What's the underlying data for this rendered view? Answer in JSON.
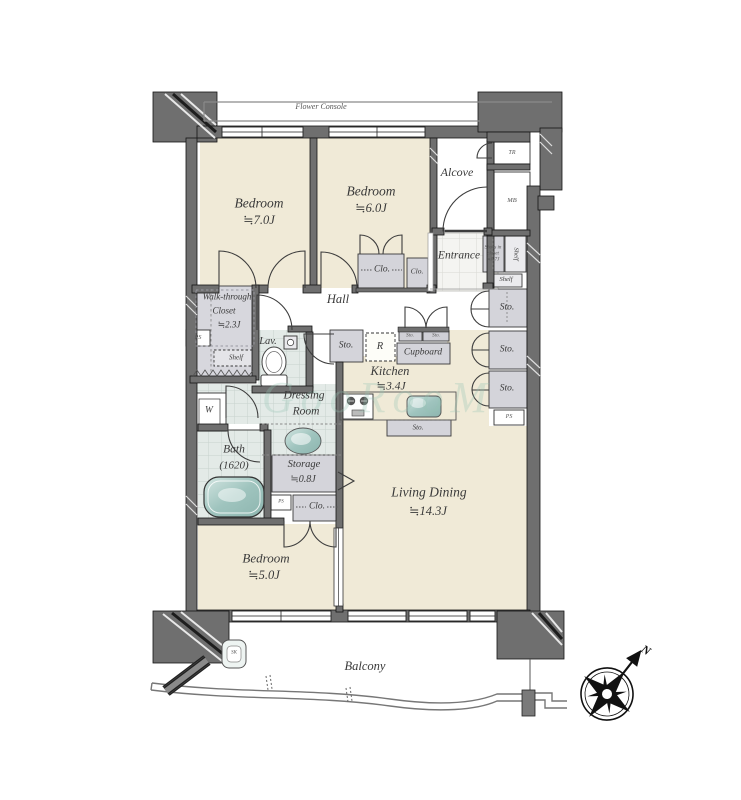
{
  "labels": {
    "flower_console": "Flower Console",
    "bedroom_7_name": "Bedroom",
    "bedroom_7_size": "≒7.0J",
    "bedroom_6_name": "Bedroom",
    "bedroom_6_size": "≒6.0J",
    "alcove": "Alcove",
    "trunk_room": "TR",
    "meter_box": "MB",
    "entrance": "Entrance",
    "shoes_closet_l1": "Shoes in",
    "shoes_closet_l2": "closet",
    "shoes_closet_l3": "≒0.7J",
    "shelf_vertical": "Shelf",
    "shelf_entrance": "Shelf",
    "closet_bedroom6": "Clo.",
    "closet_bedroom6_small": "Clo.",
    "wtc_l1": "Walk-through",
    "wtc_l2": "Closet",
    "wtc_l3": "≒2.3J",
    "ps_left": "PS",
    "shelf_wtc": "Shelf",
    "lavatory": "Lav.",
    "hall": "Hall",
    "storage_hall": "Sto.",
    "refrigerator": "R",
    "cupboard": "Cupboard",
    "storage_small_1": "Sto.",
    "storage_small_2": "Sto.",
    "kitchen_name": "Kitchen",
    "kitchen_size": "≒3.4J",
    "storage_kitchen": "Sto.",
    "storage_right_1": "Sto.",
    "storage_right_2": "Sto.",
    "storage_right_3": "Sto.",
    "ps_right": "PS",
    "dressing_l1": "Dressing",
    "dressing_l2": "Room",
    "washer": "W",
    "bath_name": "Bath",
    "bath_size": "(1620)",
    "storage_08_name": "Storage",
    "storage_08_size": "≒0.8J",
    "ps_middle": "PS",
    "closet_bedroom5": "Clo.",
    "bedroom_5_name": "Bedroom",
    "bedroom_5_size": "≒5.0J",
    "living_dining_name": "Living Dining",
    "living_dining_size": "≒14.3J",
    "balcony": "Balcony",
    "slop_sink": "SK",
    "compass_north": "N",
    "watermark": "GooRooM"
  },
  "colors": {
    "room_beige": "#f0ead7",
    "tile_blue": "#e3eae7",
    "closet_grey": "#d4d4da",
    "wall_grey": "#6f6f6f",
    "fixture_teal": "#a8ccc6"
  }
}
